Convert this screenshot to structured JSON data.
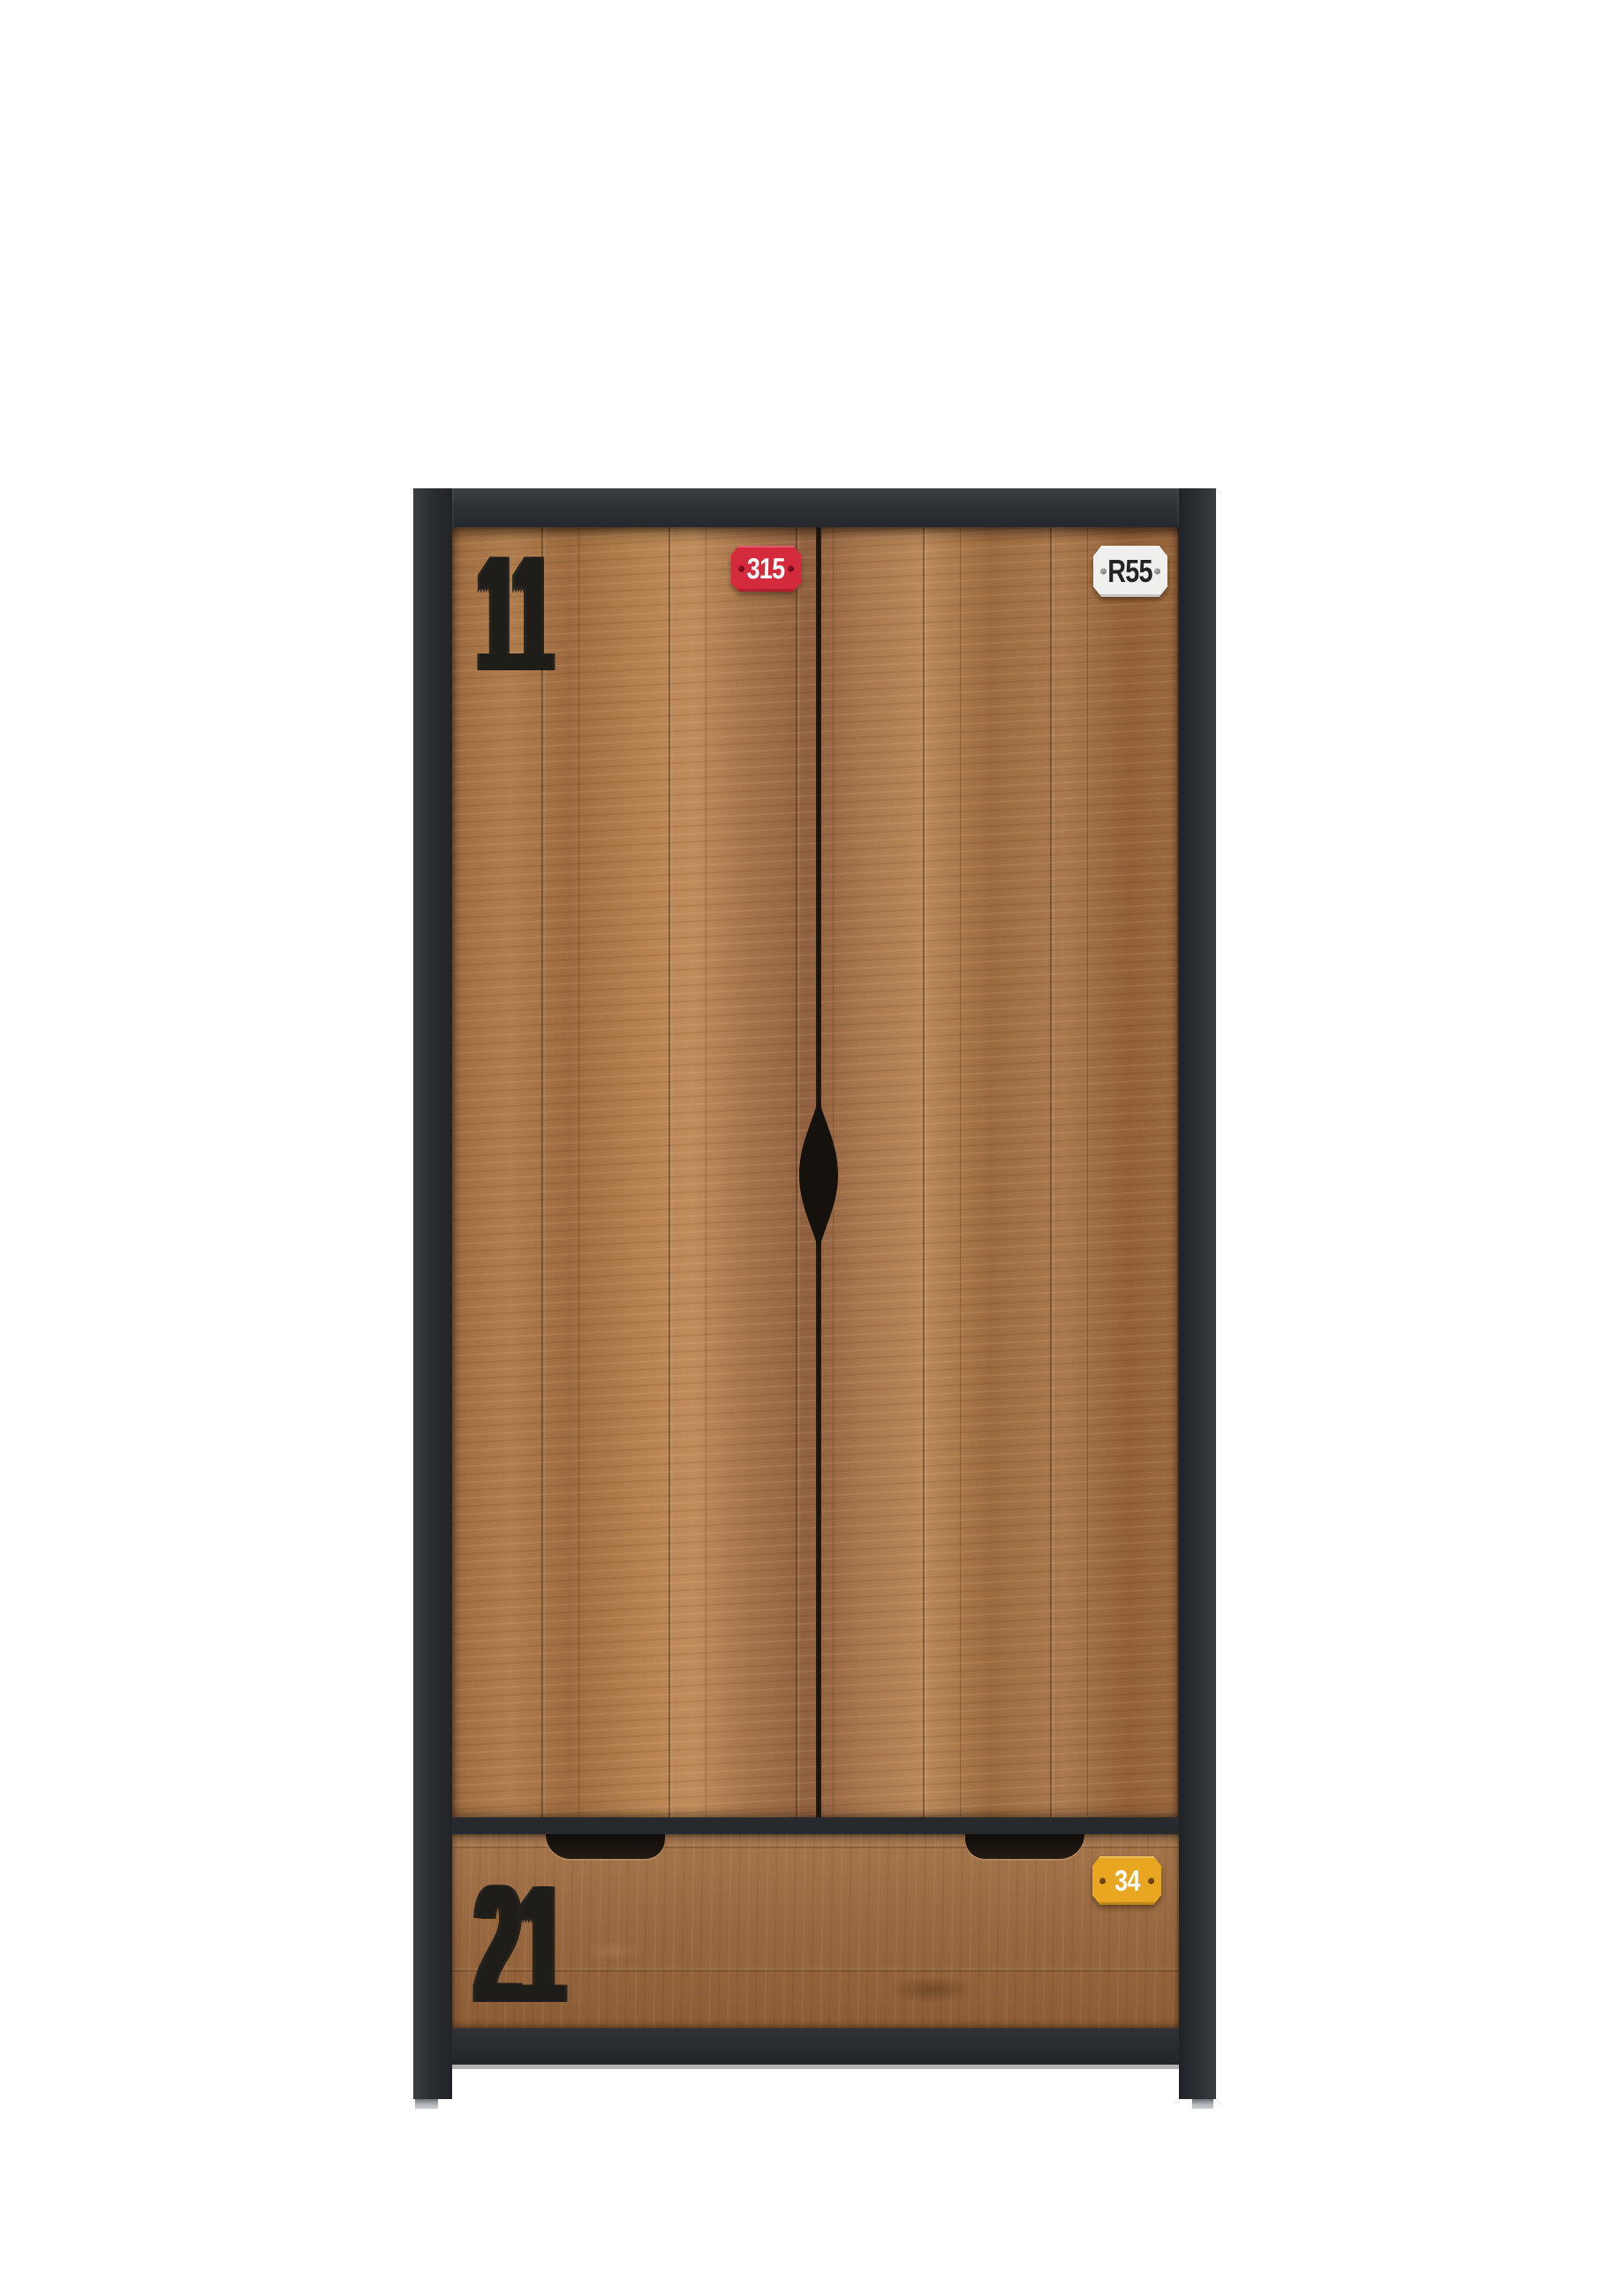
{
  "scene": {
    "type": "product-photo",
    "subject": "industrial two-door wardrobe with bottom drawer, rustic wood fronts and dark metal frame"
  },
  "decals": {
    "door_left_stencil": "11",
    "drawer_stencil": "21",
    "badges": [
      {
        "id": "door-left-badge",
        "text": "315",
        "bg": "#d5293c",
        "fg": "#ffffff"
      },
      {
        "id": "door-right-badge",
        "text": "R55",
        "bg": "#eff0ed",
        "fg": "#232323"
      },
      {
        "id": "drawer-badge",
        "text": "34",
        "bg": "#e8a621",
        "fg": "#ffffff"
      }
    ]
  },
  "palette": {
    "background": "#ffffff",
    "frame": "#2b2e32",
    "door_wood": "#a5744a",
    "drawer_wood": "#9a6a42",
    "handle_cutout": "#15110c",
    "feet": "#b1b5b8"
  }
}
